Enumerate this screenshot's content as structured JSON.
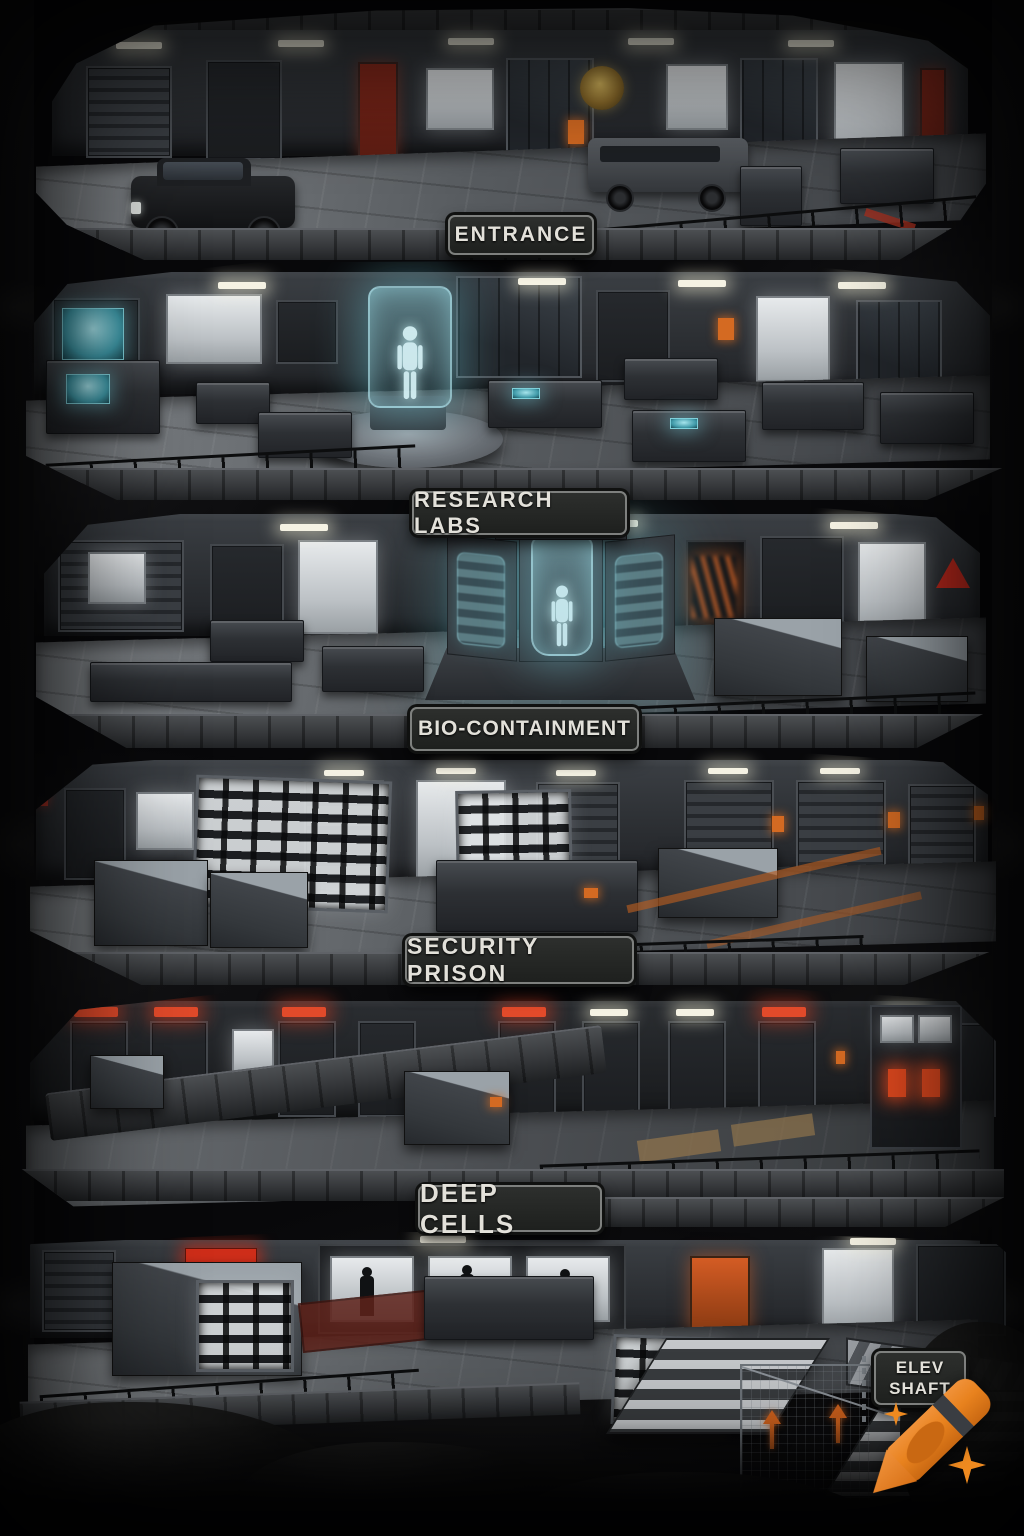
{
  "levels": [
    {
      "id": "entrance",
      "label": "ENTRANCE"
    },
    {
      "id": "research-labs",
      "label": "RESEARCH LABS"
    },
    {
      "id": "bio-containment",
      "label": "BIO-CONTAINMENT"
    },
    {
      "id": "security-prison",
      "label": "SECURITY PRISON"
    },
    {
      "id": "deep-cells",
      "label": "DEEP CELLS"
    }
  ],
  "elev_shaft": {
    "line1": "ELEV",
    "line2": "SHAFT"
  },
  "watermark": {
    "icon": "crayon-icon",
    "sparkles": "sparkle-icon",
    "color": "#e8821e"
  },
  "colors": {
    "background": "#08080a",
    "plaque_bg": "#242624",
    "plaque_border": "#7e807e",
    "plaque_text": "#e3e1da",
    "alert_red": "#e24a2a",
    "accent_orange": "#d4641e",
    "hologram_cyan": "#9fdbe2",
    "warm_light": "#f5f2e3",
    "metal_light": "#808488",
    "metal_dark": "#2c2f33"
  }
}
